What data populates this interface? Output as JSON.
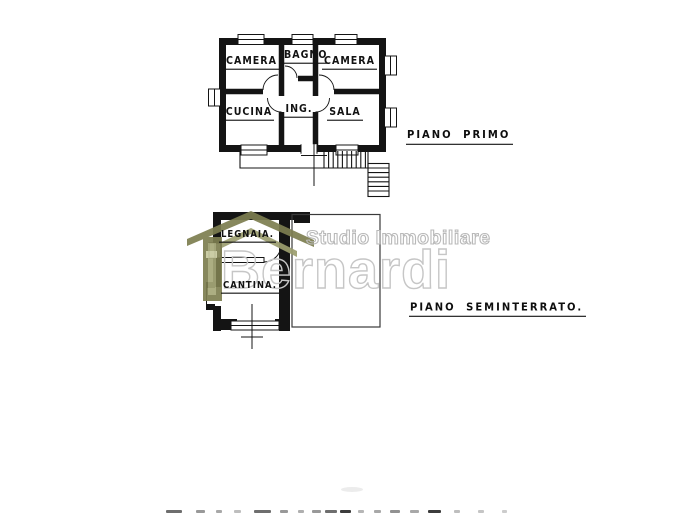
{
  "plans": {
    "first_floor": {
      "label": "PIANO PRIMO",
      "rooms": [
        {
          "name": "CAMERA"
        },
        {
          "name": "BAGNO"
        },
        {
          "name": "CAMERA"
        },
        {
          "name": "CUCINA"
        },
        {
          "name": "ING."
        },
        {
          "name": "SALA"
        }
      ]
    },
    "basement": {
      "label": "PIANO SEMINTERRATO.",
      "rooms": [
        {
          "name": "LEGNAIA."
        },
        {
          "name": "CANTINA."
        }
      ]
    }
  },
  "watermark": {
    "line1": "Studio Immobiliare",
    "line2": "Bernardi",
    "logo_icon": "house-roof-icon",
    "outline_color": "#c6c6c6",
    "roof_color_dark": "#7d7e50",
    "roof_color_light": "#9c9e6f"
  },
  "colors": {
    "ink": "#141414",
    "paper": "#ffffff"
  }
}
